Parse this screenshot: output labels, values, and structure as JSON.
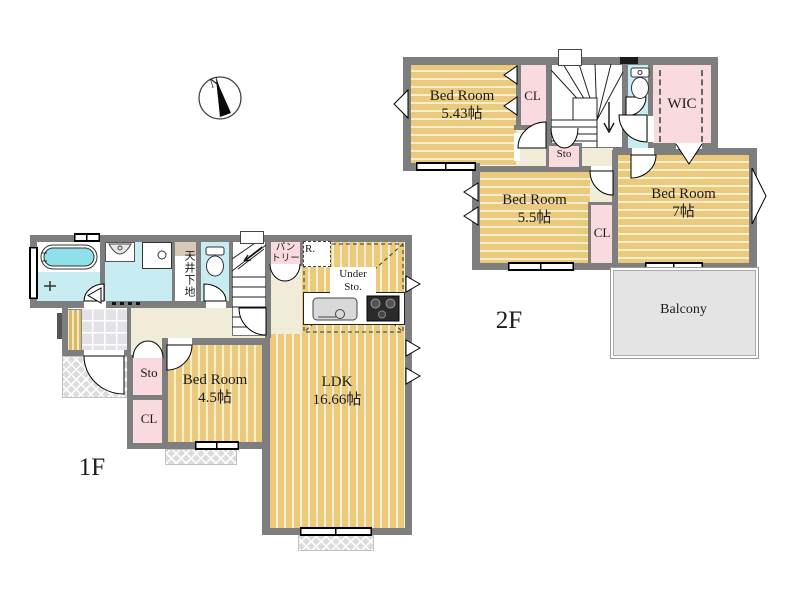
{
  "compass": {
    "label": "N"
  },
  "floor2": {
    "floor_label": "2F",
    "bedroom_a": {
      "name": "Bed Room",
      "size": "5.43帖"
    },
    "cl_top": "CL",
    "sto": "Sto",
    "wic": "WIC",
    "bedroom_b": {
      "name": "Bed Room",
      "size": "5.5帖"
    },
    "cl_mid": "CL",
    "bedroom_c": {
      "name": "Bed Room",
      "size": "7帖"
    },
    "balcony": "Balcony"
  },
  "floor1": {
    "floor_label": "1F",
    "bedroom": {
      "name": "Bed Room",
      "size": "4.5帖"
    },
    "ldk": {
      "name": "LDK",
      "size": "16.66帖"
    },
    "sto": "Sto",
    "cl": "CL",
    "pantry": {
      "line1": "パン",
      "line2": "トリー"
    },
    "ceiling": "天井下地",
    "fridge": "R.",
    "under_sto": {
      "line1": "Under",
      "line2": "Sto."
    }
  },
  "colors": {
    "room_floor": "#ecca7d",
    "floor_stripe": "#f8efcd",
    "closet_pink": "#f9dade",
    "wet_area_cyan": "#c7edf3",
    "hall_cream": "#f1ecd8",
    "balcony_gray": "#e4e4e4",
    "wall_gray": "#7e7e7e",
    "bathtub_cyan": "#8fe0ea"
  }
}
